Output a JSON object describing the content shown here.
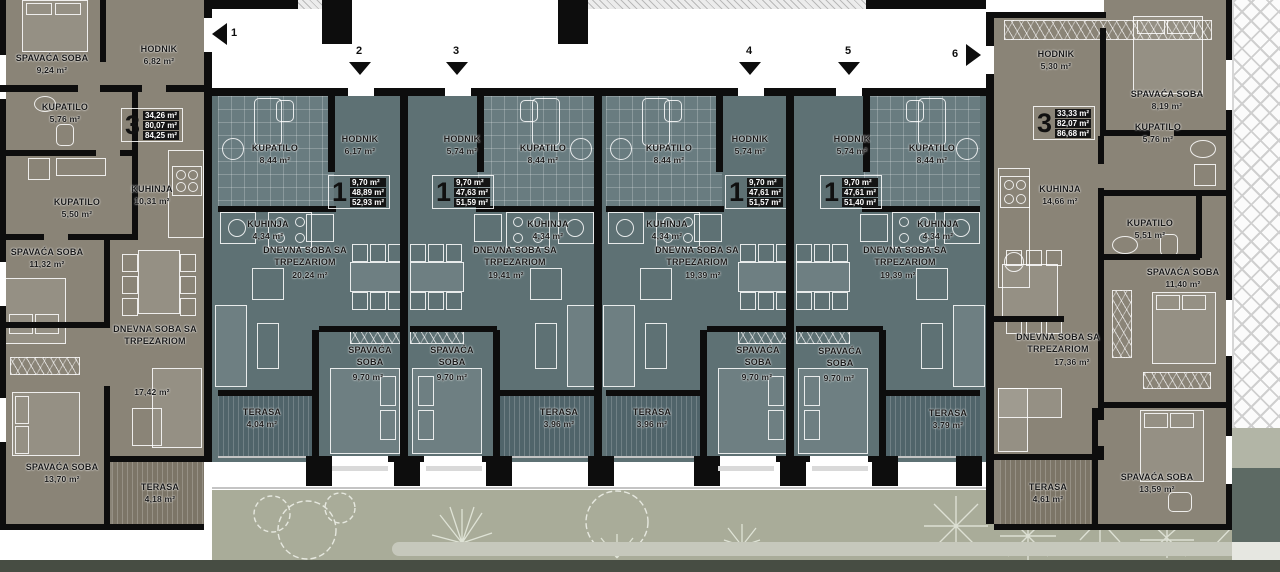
{
  "plan_title": "Floor plan – level with units 1 and 3",
  "colors": {
    "large_apartment_floor": "#8a8477",
    "small_apartment_floor": "#5e7174",
    "bathroom_floor": "#697c80",
    "small_terrace_floor": "#50646a",
    "large_terrace_floor": "#7c7567",
    "garden": "#a9ac99",
    "path": "#c6c8bc",
    "wall": "#0d0d0d"
  },
  "markers": [
    {
      "label": "1",
      "direction": "left"
    },
    {
      "label": "2",
      "direction": "down"
    },
    {
      "label": "3",
      "direction": "down"
    },
    {
      "label": "4",
      "direction": "down"
    },
    {
      "label": "5",
      "direction": "down"
    },
    {
      "label": "6",
      "direction": "right"
    }
  ],
  "apartments": {
    "left": {
      "type_number": "3",
      "type_areas": [
        "34,26 m²",
        "80,07 m²",
        "84,25 m²"
      ],
      "rooms": {
        "bedroom_top": {
          "name": "SPAVAĆA SOBA",
          "area": "9,24 m²"
        },
        "hallway": {
          "name": "HODNIK",
          "area": "6,82 m²"
        },
        "bathroom_top": {
          "name": "KUPATILO",
          "area": "5,76 m²"
        },
        "kitchen": {
          "name": "KUHINJA",
          "area": "10,31 m²"
        },
        "bathroom_mid": {
          "name": "KUPATILO",
          "area": "5,50 m²"
        },
        "bedroom_mid": {
          "name": "SPAVAĆA SOBA",
          "area": "11,32 m²"
        },
        "living": {
          "name": "DNEVNA SOBA SA TRPEZARIOM",
          "area": "17,42 m²"
        },
        "bedroom_bottom": {
          "name": "SPAVAĆA SOBA",
          "area": "13,70 m²"
        },
        "terrace": {
          "name": "TERASA",
          "area": "4,18 m²"
        }
      }
    },
    "unit1": {
      "type_number": "1",
      "type_areas": [
        "9,70 m²",
        "48,89 m²",
        "52,93 m²"
      ],
      "rooms": {
        "bathroom": {
          "name": "KUPATILO",
          "area": "8,44 m²"
        },
        "hallway": {
          "name": "HODNIK",
          "area": "6,17 m²"
        },
        "kitchen": {
          "name": "KUHINJA",
          "area": "4,34 m²"
        },
        "living": {
          "name": "DNEVNA SOBA SA TRPEZARIOM",
          "area": "20,24 m²"
        },
        "bedroom": {
          "name": "SPAVAĆA SOBA",
          "area": "9,70 m²"
        },
        "terrace": {
          "name": "TERASA",
          "area": "4,04 m²"
        }
      }
    },
    "unit2": {
      "type_number": "1",
      "type_areas": [
        "9,70 m²",
        "47,63 m²",
        "51,59 m²"
      ],
      "rooms": {
        "hallway": {
          "name": "HODNIK",
          "area": "5,74 m²"
        },
        "bathroom": {
          "name": "KUPATILO",
          "area": "8,44 m²"
        },
        "kitchen": {
          "name": "KUHINJA",
          "area": "4,34 m²"
        },
        "living": {
          "name": "DNEVNA SOBA SA TRPEZARIOM",
          "area": "19,41 m²"
        },
        "bedroom": {
          "name": "SPAVAĆA SOBA",
          "area": "9,70 m²"
        },
        "terrace": {
          "name": "TERASA",
          "area": "3,96 m²"
        }
      }
    },
    "unit3": {
      "type_number": "1",
      "type_areas": [
        "9,70 m²",
        "47,61 m²",
        "51,57 m²"
      ],
      "rooms": {
        "bathroom": {
          "name": "KUPATILO",
          "area": "8,44 m²"
        },
        "hallway": {
          "name": "HODNIK",
          "area": "5,74 m²"
        },
        "kitchen": {
          "name": "KUHINJA",
          "area": "4,34 m²"
        },
        "living": {
          "name": "DNEVNA SOBA SA TRPEZARIOM",
          "area": "19,39 m²"
        },
        "bedroom": {
          "name": "SPAVAĆA SOBA",
          "area": "9,70 m²"
        },
        "terrace": {
          "name": "TERASA",
          "area": "3,96 m²"
        }
      }
    },
    "unit4": {
      "type_number": "1",
      "type_areas": [
        "9,70 m²",
        "47,61 m²",
        "51,40 m²"
      ],
      "rooms": {
        "hallway": {
          "name": "HODNIK",
          "area": "5,74 m²"
        },
        "bathroom": {
          "name": "KUPATILO",
          "area": "8,44 m²"
        },
        "kitchen": {
          "name": "KUHINJA",
          "area": "4,34 m²"
        },
        "living": {
          "name": "DNEVNA SOBA SA TRPEZARIOM",
          "area": "19,39 m²"
        },
        "bedroom": {
          "name": "SPAVAĆA SOBA",
          "area": "9,70 m²"
        },
        "terrace": {
          "name": "TERASA",
          "area": "3,79 m²"
        }
      }
    },
    "right": {
      "type_number": "3",
      "type_areas": [
        "33,33 m²",
        "82,07 m²",
        "86,68 m²"
      ],
      "rooms": {
        "hallway": {
          "name": "HODNIK",
          "area": "5,30 m²"
        },
        "bedroom_top": {
          "name": "SPAVAĆA SOBA",
          "area": "8,19 m²"
        },
        "bathroom_top": {
          "name": "KUPATILO",
          "area": "5,76 m²"
        },
        "kitchen": {
          "name": "KUHINJA",
          "area": "14,66 m²"
        },
        "bathroom_mid": {
          "name": "KUPATILO",
          "area": "5,51 m²"
        },
        "bedroom_mid": {
          "name": "SPAVAĆA SOBA",
          "area": "11,40 m²"
        },
        "living": {
          "name": "DNEVNA SOBA SA TRPEZARIOM",
          "area": "17,36 m²"
        },
        "bedroom_bottom": {
          "name": "SPAVAĆA SOBA",
          "area": "13,59 m²"
        },
        "terrace": {
          "name": "TERASA",
          "area": "4,61 m²"
        }
      }
    }
  }
}
